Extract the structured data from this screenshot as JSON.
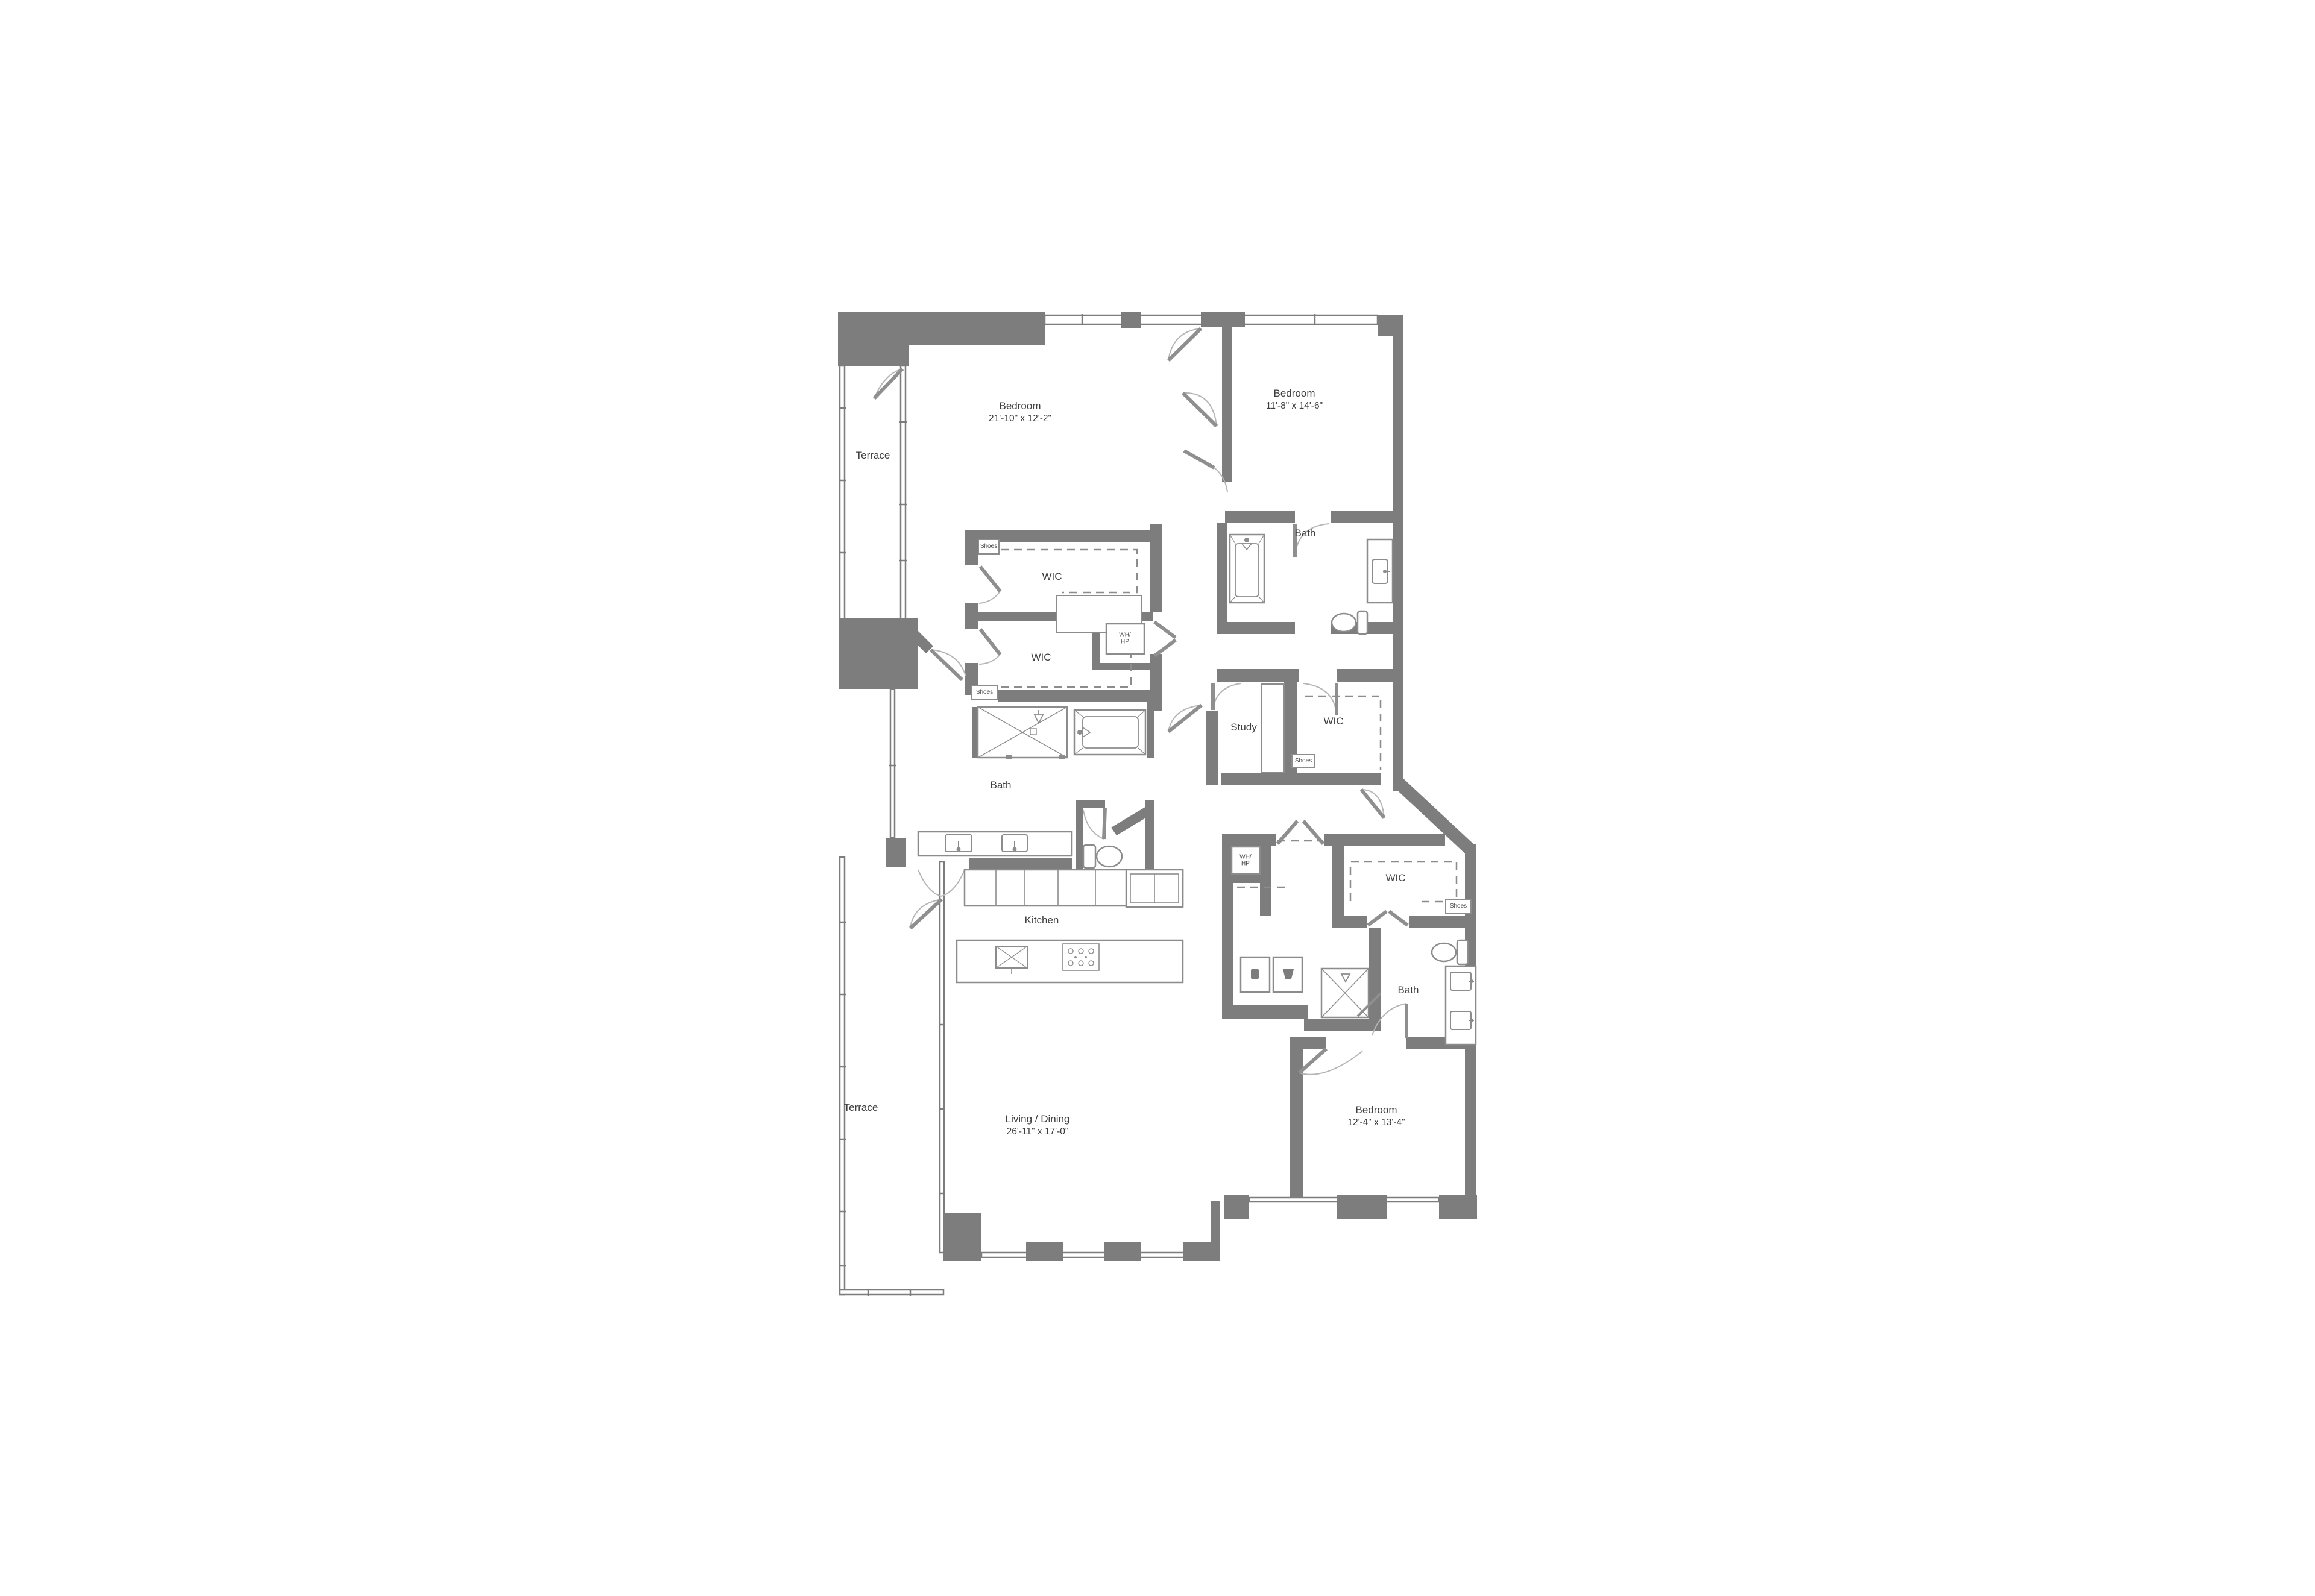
{
  "plan_title": "Residence floor plan",
  "colors": {
    "wall": "#7d7d7d",
    "fixture_line": "#8c8c8c",
    "swing_line": "#b5b5b5",
    "text": "#3e3e3e",
    "background": "#ffffff"
  },
  "rooms": {
    "bedroom1": {
      "label": "Bedroom",
      "dims": "21'-10\" x 12'-2\""
    },
    "bedroom2": {
      "label": "Bedroom",
      "dims": "11'-8\" x 14'-6\""
    },
    "bedroom3": {
      "label": "Bedroom",
      "dims": "12'-4\" x 13'-4\""
    },
    "living": {
      "label": "Living / Dining",
      "dims": "26'-11\" x 17'-0\""
    },
    "kitchen": {
      "label": "Kitchen"
    },
    "study": {
      "label": "Study"
    },
    "terrace_upper": {
      "label": "Terrace"
    },
    "terrace_lower": {
      "label": "Terrace"
    },
    "bath_master": {
      "label": "Bath"
    },
    "bath2": {
      "label": "Bath"
    },
    "bath3": {
      "label": "Bath"
    },
    "wic_a": {
      "label": "WIC"
    },
    "wic_b": {
      "label": "WIC"
    },
    "wic_hall": {
      "label": "WIC"
    },
    "wic_bed3": {
      "label": "WIC"
    }
  },
  "closets": {
    "wh_hp_line1": "WH/",
    "wh_hp_line2": "HP",
    "shoes": "Shoes"
  }
}
